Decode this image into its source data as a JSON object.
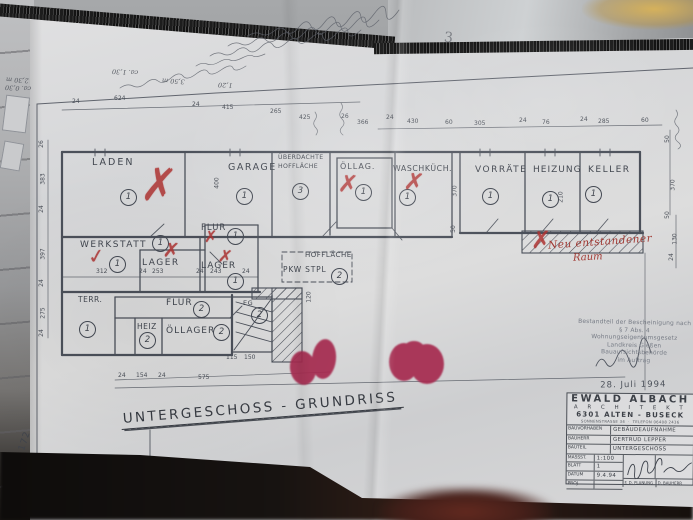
{
  "colors": {
    "paper": "#d8d9da",
    "ink": "#4b505a",
    "red_mark": "#ae3332",
    "red_seal": "#a62a4f",
    "table_gray": "#a2a4a6",
    "gold_reflection": "#c9a94e",
    "shadow": "#15100d"
  },
  "annotations": {
    "page_number": "3",
    "sheet_margin_number": "172"
  },
  "handwriting": {
    "illegible_line_count": 5,
    "fragments": [
      {
        "t": "2,30 m",
        "x": 6,
        "y": 76
      },
      {
        "t": "ca. 0,30",
        "x": 5,
        "y": 84
      },
      {
        "t": "ca. 1,30",
        "x": 112,
        "y": 68
      },
      {
        "t": "3,50 m",
        "x": 162,
        "y": 77
      },
      {
        "t": "1,20",
        "x": 218,
        "y": 81
      }
    ]
  },
  "plan": {
    "title": "UNTERGESCHOSS - GRUNDRISS",
    "red_note": {
      "line1": "Neu entstandener",
      "line2": "Raum"
    },
    "room_labels": [
      {
        "t": "LADEN",
        "x": 92,
        "y": 158,
        "s": 9.5,
        "ls": 2
      },
      {
        "t": "GARAGE",
        "x": 228,
        "y": 163,
        "s": 9.5,
        "ls": 1.5
      },
      {
        "t": "ÜBERDACHTE",
        "x": 278,
        "y": 155,
        "s": 6.2,
        "ls": 0.3
      },
      {
        "t": "HOFFLÄCHE",
        "x": 278,
        "y": 164,
        "s": 6.2,
        "ls": 0.3
      },
      {
        "t": "ÖLLAG.",
        "x": 340,
        "y": 163,
        "s": 8,
        "ls": 1
      },
      {
        "t": "WASCHKÜCH.",
        "x": 393,
        "y": 165,
        "s": 7.8,
        "ls": 0.6
      },
      {
        "t": "VORRÄTE",
        "x": 475,
        "y": 166,
        "s": 9,
        "ls": 1.5
      },
      {
        "t": "HEIZUNG",
        "x": 533,
        "y": 166,
        "s": 9,
        "ls": 1
      },
      {
        "t": "KELLER",
        "x": 588,
        "y": 166,
        "s": 9,
        "ls": 1.5
      },
      {
        "t": "WERKSTATT",
        "x": 80,
        "y": 241,
        "s": 9,
        "ls": 1.5
      },
      {
        "t": "FLUR",
        "x": 201,
        "y": 224,
        "s": 8.5,
        "ls": 1
      },
      {
        "t": "LAGER",
        "x": 142,
        "y": 259,
        "s": 9,
        "ls": 1.5
      },
      {
        "t": "LAGER",
        "x": 201,
        "y": 262,
        "s": 9,
        "ls": 1
      },
      {
        "t": "HOFFLÄCHE",
        "x": 305,
        "y": 252,
        "s": 7,
        "ls": 0.5
      },
      {
        "t": "PKW STPL",
        "x": 283,
        "y": 266,
        "s": 7.5,
        "ls": 0.8
      },
      {
        "t": "TERR.",
        "x": 78,
        "y": 296,
        "s": 7.5,
        "ls": 0.5
      },
      {
        "t": "FLUR",
        "x": 166,
        "y": 299,
        "s": 9,
        "ls": 1
      },
      {
        "t": "HEIZ",
        "x": 137,
        "y": 323,
        "s": 7.5,
        "ls": 0.5
      },
      {
        "t": "ÖLLAGER",
        "x": 166,
        "y": 327,
        "s": 9,
        "ls": 1
      },
      {
        "t": "EG",
        "x": 243,
        "y": 300,
        "s": 6.5,
        "ls": 0.5
      }
    ],
    "room_numbers": [
      {
        "n": "1",
        "x": 120,
        "y": 189
      },
      {
        "n": "1",
        "x": 236,
        "y": 188
      },
      {
        "n": "3",
        "x": 292,
        "y": 183
      },
      {
        "n": "1",
        "x": 355,
        "y": 184
      },
      {
        "n": "1",
        "x": 399,
        "y": 189
      },
      {
        "n": "1",
        "x": 482,
        "y": 188
      },
      {
        "n": "1",
        "x": 542,
        "y": 191
      },
      {
        "n": "1",
        "x": 585,
        "y": 186
      },
      {
        "n": "1",
        "x": 109,
        "y": 256
      },
      {
        "n": "1",
        "x": 152,
        "y": 235
      },
      {
        "n": "1",
        "x": 227,
        "y": 228
      },
      {
        "n": "1",
        "x": 227,
        "y": 273
      },
      {
        "n": "1",
        "x": 79,
        "y": 321
      },
      {
        "n": "2",
        "x": 193,
        "y": 301
      },
      {
        "n": "2",
        "x": 139,
        "y": 332
      },
      {
        "n": "2",
        "x": 213,
        "y": 324
      },
      {
        "n": "2",
        "x": 251,
        "y": 307
      },
      {
        "n": "2",
        "x": 331,
        "y": 268
      }
    ],
    "red_marks": [
      {
        "g": "✗",
        "x": 142,
        "y": 166,
        "s": 40,
        "r": 8,
        "sy": 1.2
      },
      {
        "g": "✓",
        "x": 88,
        "y": 246,
        "s": 20,
        "r": -8,
        "sy": 1
      },
      {
        "g": "✗",
        "x": 163,
        "y": 240,
        "s": 20,
        "r": 5,
        "sy": 1
      },
      {
        "g": "✗",
        "x": 204,
        "y": 229,
        "s": 16,
        "r": 0,
        "sy": 1
      },
      {
        "g": "✗",
        "x": 218,
        "y": 249,
        "s": 17,
        "r": 8,
        "sy": 1
      },
      {
        "g": "✗",
        "x": 338,
        "y": 172,
        "s": 24,
        "r": 5,
        "sy": 1
      },
      {
        "g": "✗",
        "x": 404,
        "y": 170,
        "s": 24,
        "r": 8,
        "sy": 1
      },
      {
        "g": "✗",
        "x": 531,
        "y": 228,
        "s": 24,
        "r": 0,
        "sy": 1
      }
    ],
    "dimensions": [
      {
        "t": "24",
        "x": 72,
        "y": 99
      },
      {
        "t": "624",
        "x": 114,
        "y": 96
      },
      {
        "t": "24",
        "x": 192,
        "y": 102
      },
      {
        "t": "415",
        "x": 222,
        "y": 105
      },
      {
        "t": "265",
        "x": 270,
        "y": 109
      },
      {
        "t": "425",
        "x": 299,
        "y": 115
      },
      {
        "t": "26",
        "x": 341,
        "y": 114
      },
      {
        "t": "366",
        "x": 357,
        "y": 120
      },
      {
        "t": "24",
        "x": 386,
        "y": 115
      },
      {
        "t": "430",
        "x": 407,
        "y": 119
      },
      {
        "t": "60",
        "x": 445,
        "y": 120
      },
      {
        "t": "305",
        "x": 474,
        "y": 121
      },
      {
        "t": "24",
        "x": 519,
        "y": 118
      },
      {
        "t": "76",
        "x": 542,
        "y": 120
      },
      {
        "t": "24",
        "x": 580,
        "y": 117
      },
      {
        "t": "285",
        "x": 598,
        "y": 119
      },
      {
        "t": "60",
        "x": 641,
        "y": 118
      },
      {
        "t": "26",
        "x": 38,
        "y": 141,
        "r": -90
      },
      {
        "t": "383",
        "x": 38,
        "y": 176,
        "r": -90
      },
      {
        "t": "24",
        "x": 38,
        "y": 206,
        "r": -90
      },
      {
        "t": "397",
        "x": 38,
        "y": 251,
        "r": -90
      },
      {
        "t": "24",
        "x": 38,
        "y": 280,
        "r": -90
      },
      {
        "t": "275",
        "x": 38,
        "y": 310,
        "r": -90
      },
      {
        "t": "24",
        "x": 38,
        "y": 330,
        "r": -90
      },
      {
        "t": "50",
        "x": 664,
        "y": 136,
        "r": -90
      },
      {
        "t": "370",
        "x": 668,
        "y": 182,
        "r": -90
      },
      {
        "t": "50",
        "x": 664,
        "y": 212,
        "r": -90
      },
      {
        "t": "130",
        "x": 670,
        "y": 236,
        "r": -90
      },
      {
        "t": "24",
        "x": 668,
        "y": 254,
        "r": -90
      },
      {
        "t": "400",
        "x": 212,
        "y": 180,
        "r": -90
      },
      {
        "t": "370",
        "x": 450,
        "y": 188,
        "r": -90
      },
      {
        "t": "210",
        "x": 556,
        "y": 194,
        "r": -90
      },
      {
        "t": "50",
        "x": 450,
        "y": 226,
        "r": -90
      },
      {
        "t": "120",
        "x": 304,
        "y": 294,
        "r": -90
      },
      {
        "t": "312",
        "x": 96,
        "y": 269
      },
      {
        "t": "24",
        "x": 139,
        "y": 269
      },
      {
        "t": "253",
        "x": 152,
        "y": 269
      },
      {
        "t": "24",
        "x": 196,
        "y": 269
      },
      {
        "t": "243",
        "x": 210,
        "y": 269
      },
      {
        "t": "24",
        "x": 242,
        "y": 269
      },
      {
        "t": "24",
        "x": 118,
        "y": 373
      },
      {
        "t": "154",
        "x": 136,
        "y": 373
      },
      {
        "t": "24",
        "x": 158,
        "y": 373
      },
      {
        "t": "575",
        "x": 198,
        "y": 375
      },
      {
        "t": "115",
        "x": 226,
        "y": 355
      },
      {
        "t": "150",
        "x": 244,
        "y": 355
      }
    ]
  },
  "stamp": {
    "lines": [
      "Bestandteil der Bescheinigung nach",
      "§ 7 Abs. 4 Wohnungseigentumsgesetz",
      "Landkreis Gießen",
      "Bauaufsichtsbehörde",
      "im Auftrag"
    ],
    "date": "28. Juli 1994"
  },
  "title_block": {
    "name": "EWALD ALBACH",
    "profession": "A R C H I T E K T",
    "city": "6301 ALTEN - BUSECK",
    "address": "SONNENSTRASSE 34",
    "phone": "TELEFON 06408 2436",
    "rows": [
      {
        "label": "BAUVORHABEN",
        "value": "GEBÄUDEAUFNAHME"
      },
      {
        "label": "BAUHERR",
        "value": "GERTRUD LEPPER"
      },
      {
        "label": "BAUTEIL",
        "value": "UNTERGESCHOSS"
      },
      {
        "label": "MASSST.",
        "value": "1:100"
      },
      {
        "label": "BLATT",
        "value": "1"
      },
      {
        "label": "DATUM",
        "value": "9.4.94"
      },
      {
        "label": "PROJ.",
        "value": ""
      }
    ],
    "footer": [
      "F. D. PLANUNG",
      "D. BAUHERR"
    ]
  }
}
